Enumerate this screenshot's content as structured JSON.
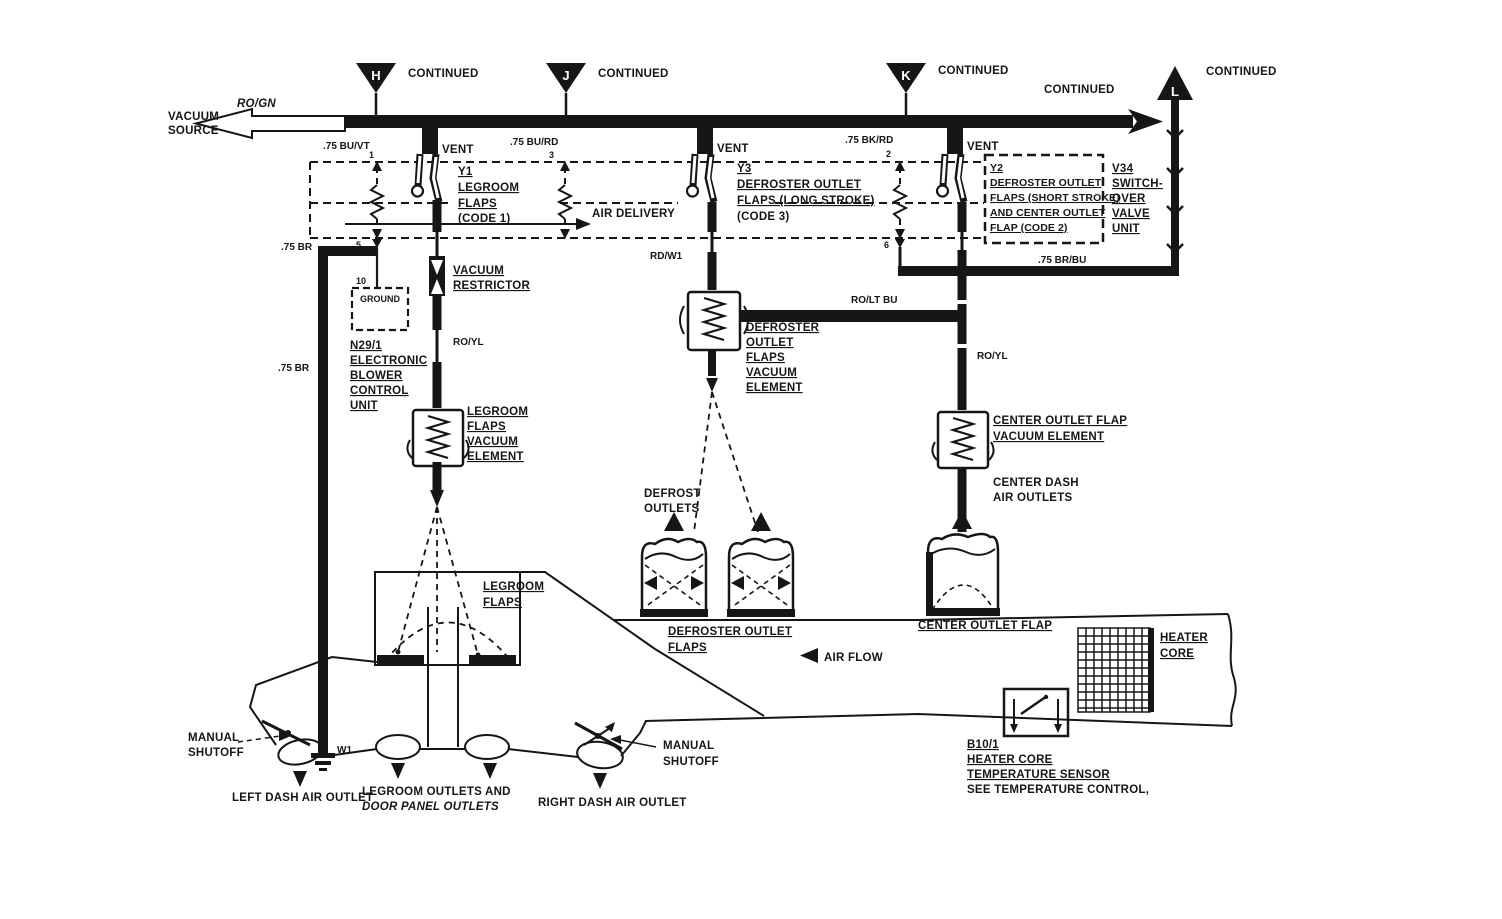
{
  "colors": {
    "ink": "#161616",
    "paper": "#ffffff"
  },
  "source": {
    "line1": "VACUUM",
    "line2": "SOURCE",
    "wire": "RO/GN"
  },
  "connectors": {
    "h": {
      "id": "H",
      "label": "CONTINUED"
    },
    "j": {
      "id": "J",
      "label": "CONTINUED"
    },
    "k": {
      "id": "K",
      "label": "CONTINUED"
    },
    "l": {
      "id": "L",
      "label": "CONTINUED"
    },
    "main_end": {
      "label": "CONTINUED"
    }
  },
  "vents": {
    "left": "VENT",
    "middle": "VENT",
    "right": "VENT"
  },
  "wires": {
    "bu_vt": ".75 BU/VT",
    "bu_rd": ".75 BU/RD",
    "bk_rd": ".75 BK/RD",
    "br_upper": ".75 BR",
    "br_lower": ".75 BR",
    "rd_w1": "RD/W1",
    "ro_yl_left": "RO/YL",
    "ro_lt_bu": "RO/LT BU",
    "ro_yl_right": "RO/YL",
    "br_bu": ".75 BR/BU"
  },
  "ports": {
    "left_top": "1",
    "mid_top": "3",
    "right_top": "2",
    "left_bottom": "5",
    "right_bottom": "6",
    "ground_terminal": "10"
  },
  "valves": {
    "y1": {
      "lines": [
        "Y1",
        "LEGROOM",
        "FLAPS",
        "(CODE 1)"
      ]
    },
    "y3": {
      "lines": [
        "Y3",
        "DEFROSTER OUTLET",
        "FLAPS (LONG STROKE)",
        "(CODE 3)"
      ]
    },
    "y2": {
      "lines": [
        "Y2",
        "DEFROSTER OUTLET",
        "FLAPS (SHORT STROKE)",
        "AND CENTER OUTLET",
        "FLAP (CODE 2)"
      ]
    },
    "v34": {
      "lines": [
        "V34",
        "SWITCH-",
        "OVER",
        "VALVE",
        "UNIT"
      ]
    }
  },
  "air_delivery": "AIR DELIVERY",
  "ground_box": "GROUND",
  "n29": {
    "lines": [
      "N29/1",
      "ELECTRONIC",
      "BLOWER",
      "CONTROL",
      "UNIT"
    ]
  },
  "w1": "W1",
  "restrictor": {
    "lines": [
      "VACUUM",
      "RESTRICTOR"
    ]
  },
  "elements": {
    "legroom": {
      "lines": [
        "LEGROOM",
        "FLAPS",
        "VACUUM",
        "ELEMENT"
      ]
    },
    "defroster": {
      "lines": [
        "DEFROSTER",
        "OUTLET",
        "FLAPS",
        "VACUUM",
        "ELEMENT"
      ]
    },
    "center": {
      "lines": [
        "CENTER OUTLET FLAP",
        "VACUUM ELEMENT"
      ]
    }
  },
  "outlets": {
    "defrost": {
      "lines": [
        "DEFROST",
        "OUTLETS"
      ]
    },
    "center_dash": {
      "lines": [
        "CENTER DASH",
        "AIR OUTLETS"
      ]
    },
    "left_dash": "LEFT DASH AIR OUTLET",
    "legroom": {
      "lines": [
        "LEGROOM OUTLETS AND",
        "DOOR PANEL OUTLETS"
      ]
    },
    "right_dash": "RIGHT DASH AIR OUTLET"
  },
  "flaps": {
    "legroom": {
      "lines": [
        "LEGROOM",
        "FLAPS"
      ]
    },
    "defroster": {
      "lines": [
        "DEFROSTER OUTLET",
        "FLAPS"
      ]
    },
    "center": "CENTER OUTLET FLAP"
  },
  "air_flow": "AIR FLOW",
  "heater_core": {
    "lines": [
      "HEATER",
      "CORE"
    ]
  },
  "manual_shutoff_left": {
    "lines": [
      "MANUAL",
      "SHUTOFF"
    ]
  },
  "manual_shutoff_right": {
    "lines": [
      "MANUAL",
      "SHUTOFF"
    ]
  },
  "b10": {
    "lines": [
      "B10/1",
      "HEATER CORE",
      "TEMPERATURE SENSOR"
    ],
    "note": "SEE TEMPERATURE CONTROL,"
  }
}
